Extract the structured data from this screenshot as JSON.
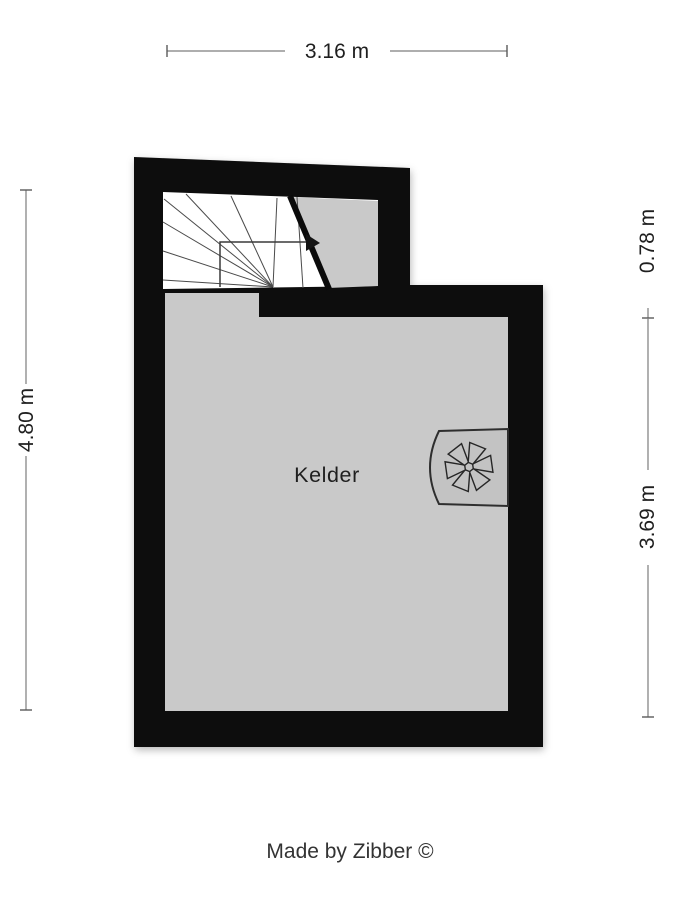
{
  "floorplan": {
    "room_label": "Kelder",
    "credit": "Made by Zibber ©",
    "dimensions": {
      "top_width": "3.16 m",
      "left_height": "4.80 m",
      "right_upper": "0.78 m",
      "right_lower": "3.69 m"
    },
    "icons": {
      "ventilation_fan": "six-blade-fan-symbol",
      "stair_arrow": "stair-direction-arrow"
    },
    "colors": {
      "wall": "#0a0a0a",
      "floor": "#c9c9c9",
      "stair_floor": "#ffffff",
      "fan_box": "#c3c3c3",
      "dimension_line": "#7d7d7d",
      "label_text": "#1f1f1f"
    }
  }
}
